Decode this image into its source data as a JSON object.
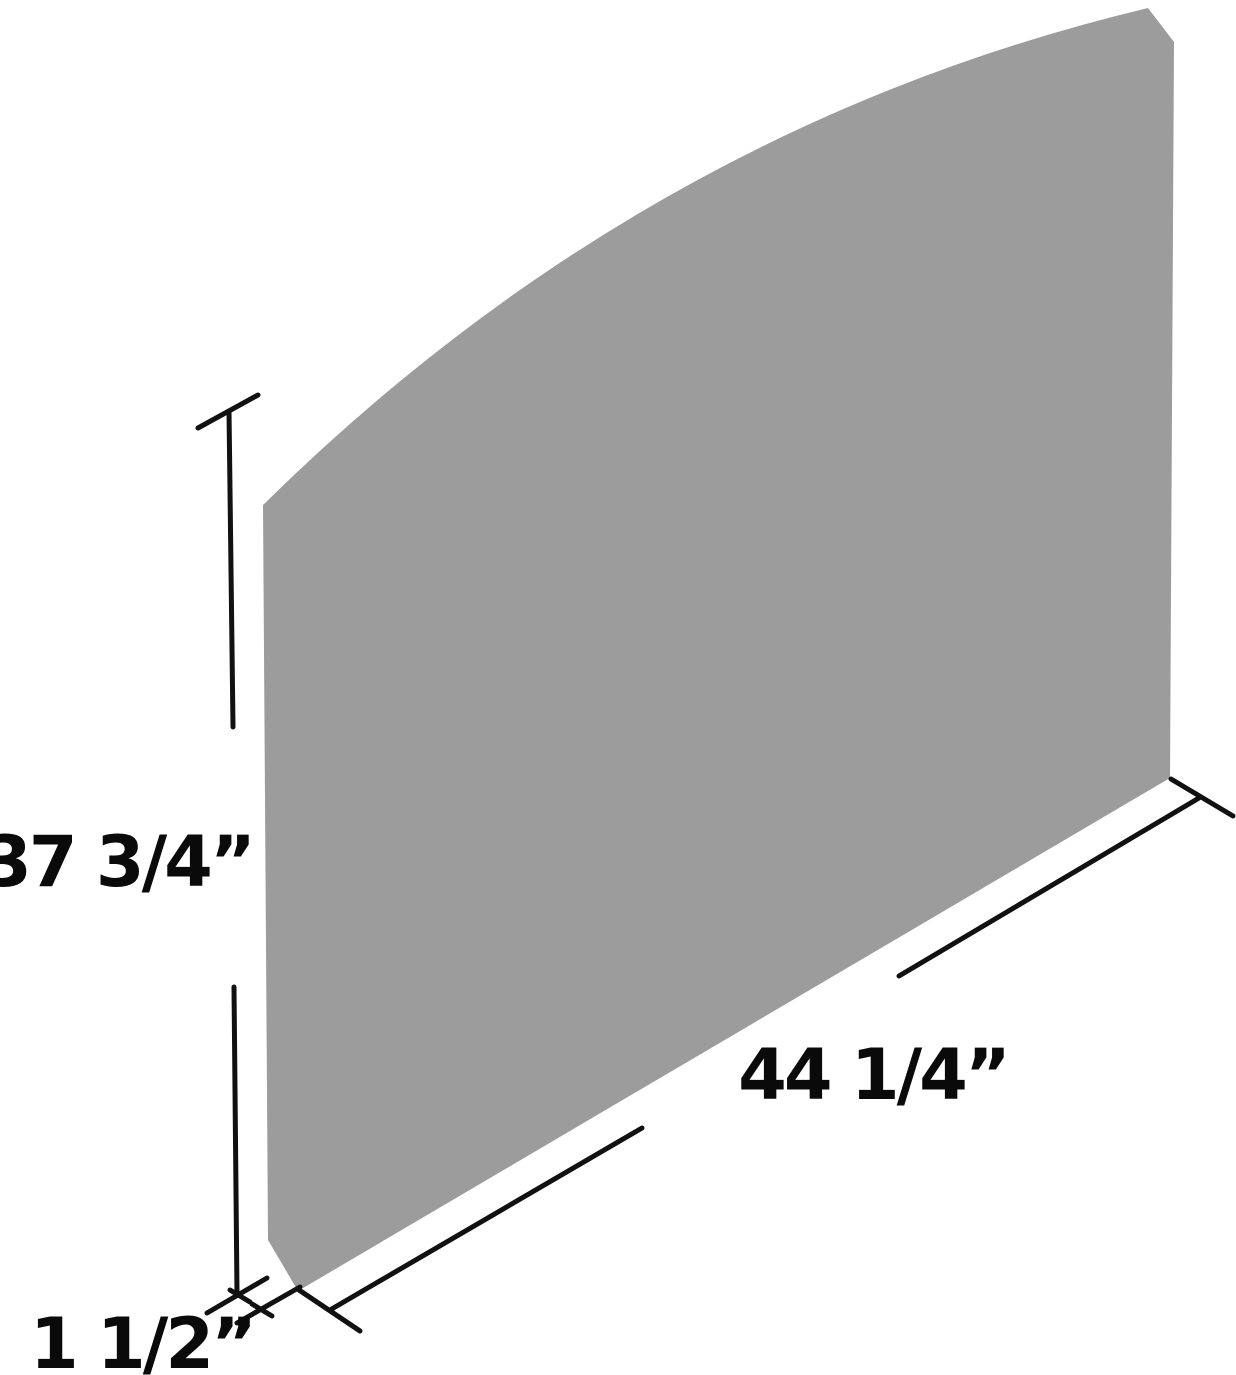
{
  "diagram": {
    "type": "product-dimension-diagram",
    "subject": "curved-top rectangular panel shown in perspective",
    "panel_color": "#9C9C9C",
    "line_color": "#111111",
    "background_color": "#FFFFFF",
    "labels": {
      "height": "37 3/4”",
      "width": "44 1/4”",
      "depth": "1 1/2”"
    }
  }
}
